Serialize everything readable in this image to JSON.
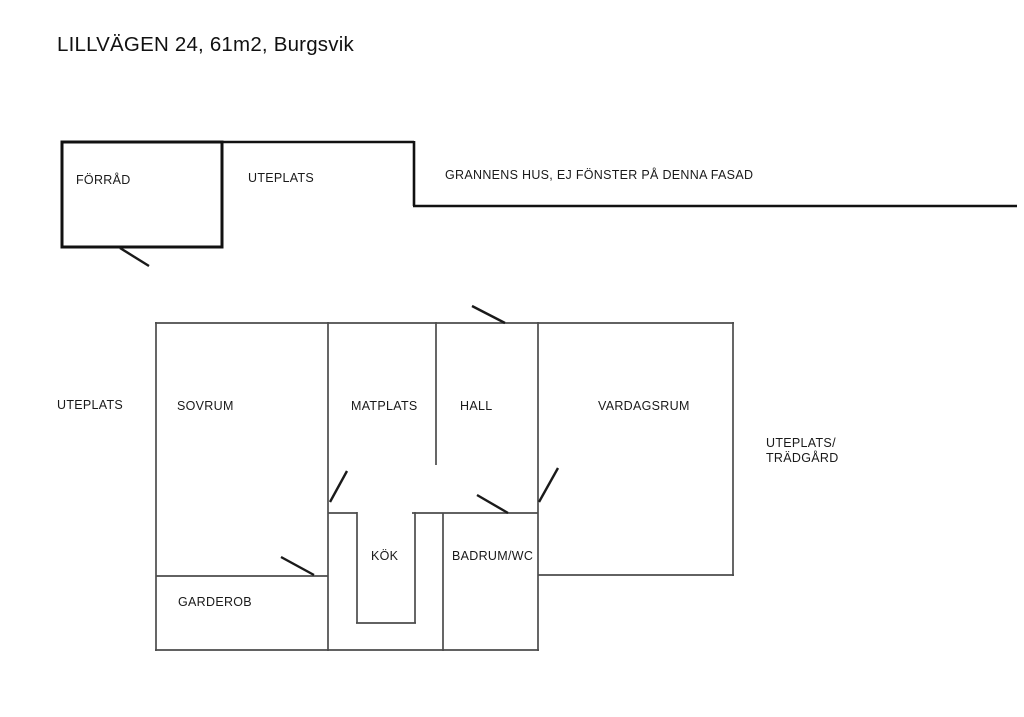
{
  "title": "LILLVÄGEN 24, 61m2, Burgsvik",
  "colors": {
    "interior_wall": "#4c4c4c",
    "outer_line": "#111111",
    "door_line": "#1a1a1a",
    "text": "#1a1a1a",
    "background": "#ffffff"
  },
  "labels": {
    "forrad": "FÖRRÅD",
    "uteplats_top": "UTEPLATS",
    "grannens_hus": "GRANNENS HUS, EJ FÖNSTER PÅ DENNA FASAD",
    "uteplats_left": "UTEPLATS",
    "sovrum": "SOVRUM",
    "matplats": "MATPLATS",
    "hall": "HALL",
    "vardagsrum": "VARDAGSRUM",
    "uteplats_tradgard_line1": "UTEPLATS/",
    "uteplats_tradgard_line2": "TRÄDGÅRD",
    "kok": "KÖK",
    "badrum_wc": "BADRUM/WC",
    "garderob": "GARDEROB"
  }
}
